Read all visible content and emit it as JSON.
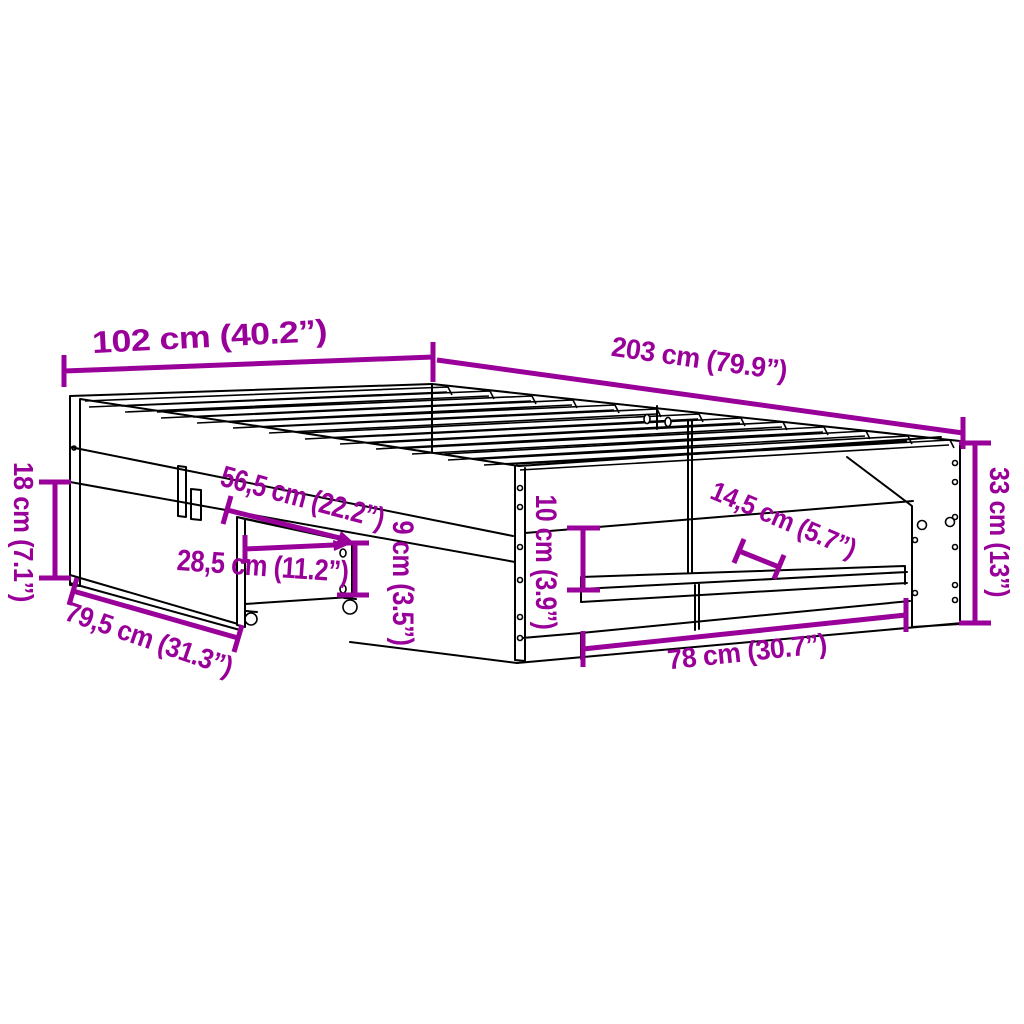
{
  "diagram": {
    "colors": {
      "accent": "#990099",
      "line": "#000000",
      "background": "#ffffff"
    },
    "dimensions": {
      "width": "102 cm (40.2”)",
      "length": "203 cm (79.9”)",
      "headboard_height": "18 cm (7.1”)",
      "frame_height": "33 cm (13”)",
      "drawer_depth": "56,5 cm (22.2”)",
      "drawer_front_width": "28,5 cm (11.2”)",
      "drawer_width": "79,5 cm (31.3”)",
      "drawer_height": "9 cm (3.5”)",
      "under_bed_clearance": "10 cm (3.9”)",
      "shelf_depth": "14,5 cm (5.7”)",
      "storage_opening_width": "78 cm (30.7”)"
    }
  }
}
